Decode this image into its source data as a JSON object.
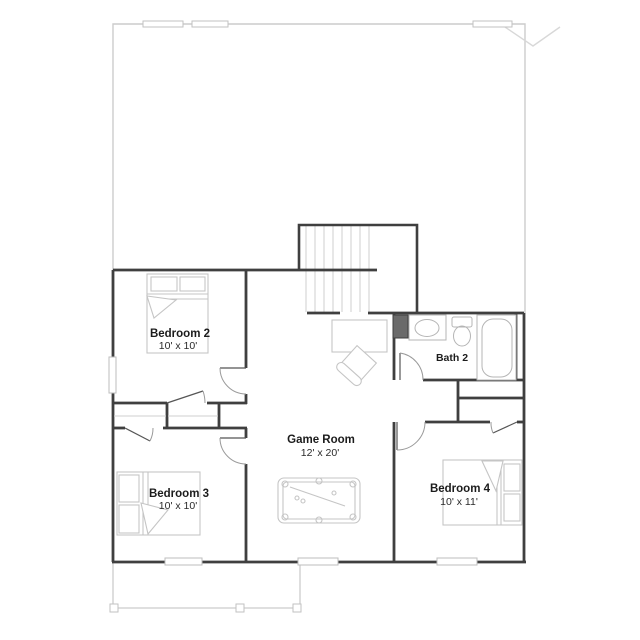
{
  "floorplan": {
    "type": "second-floor residential plan",
    "rooms": {
      "bedroom2": {
        "label": "Bedroom 2",
        "dims": "10' x 10'"
      },
      "bedroom3": {
        "label": "Bedroom 3",
        "dims": "10' x 10'"
      },
      "bedroom4": {
        "label": "Bedroom 4",
        "dims": "10' x 11'"
      },
      "gameroom": {
        "label": "Game Room",
        "dims": "12' x 20'"
      },
      "bath2": {
        "label": "Bath 2"
      }
    },
    "fixtures": [
      "stairs",
      "pool-table",
      "desk",
      "chair",
      "bed",
      "bathtub",
      "toilet",
      "sink-vanity",
      "closet-rods",
      "porch-posts",
      "windows",
      "door-swings"
    ],
    "colors": {
      "wall": "#3f3f3f",
      "light-outline": "#cccccc",
      "furniture": "#c5c5c5",
      "door-arc": "#9a9a9a",
      "chase-fill": "#6a6a6a",
      "text": "#1c1c1c",
      "background": "#ffffff"
    }
  }
}
